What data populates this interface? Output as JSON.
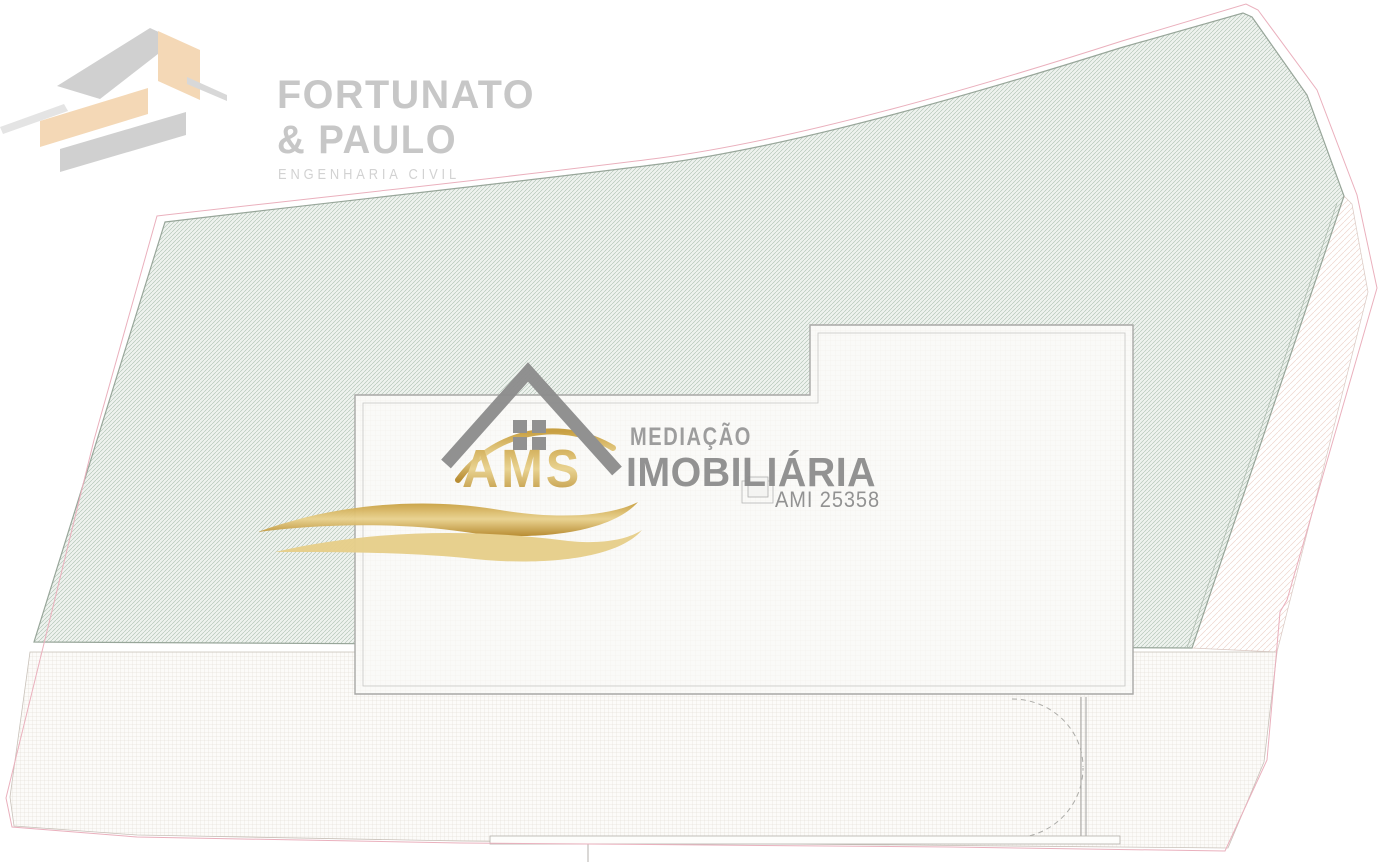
{
  "logos": {
    "fortunato_paulo": {
      "line1": "FORTUNATO",
      "line2": "& PAULO",
      "tagline": "ENGENHARIA CIVIL"
    },
    "ams": {
      "acronym": "AMS",
      "line1": "MEDIAÇÃO",
      "line2": "IMOBILIÁRIA",
      "license": "AMI 25358"
    }
  },
  "colors": {
    "fp_text": "#c7c7c7",
    "fp_tagline": "#d2d2d2",
    "fp_gray_dark": "#d0d0d0",
    "fp_gray_mid": "#d8d8d8",
    "fp_gray_light": "#e4e4e4",
    "fp_peach": "#f4d8b6",
    "ams_roof_gray": "#8d8d8d",
    "ams_caption_gray": "#9a9a9a",
    "ams_title_gray": "#8e8e8e",
    "gold_dark": "#b6892c",
    "gold_mid": "#c79d3c",
    "gold_light": "#e9d28e",
    "gold_wave": "#e7cf8a",
    "parcel_fill": "#eef2ee",
    "parcel_hatch_line": "#abbfaf",
    "parcel_stroke": "#98a69a",
    "grid_fill": "#fcfbf9",
    "grid_line": "#ded7ce",
    "road_hatch_line": "#edd5ce",
    "boundary_pink": "#eab0bd",
    "building_fill": "#fafaf8",
    "building_stroke": "#a8a8a6",
    "building_inner_stroke": "#c6c6c4",
    "detail_gray": "#acaca8",
    "wall_fill": "#fdfdfb"
  }
}
